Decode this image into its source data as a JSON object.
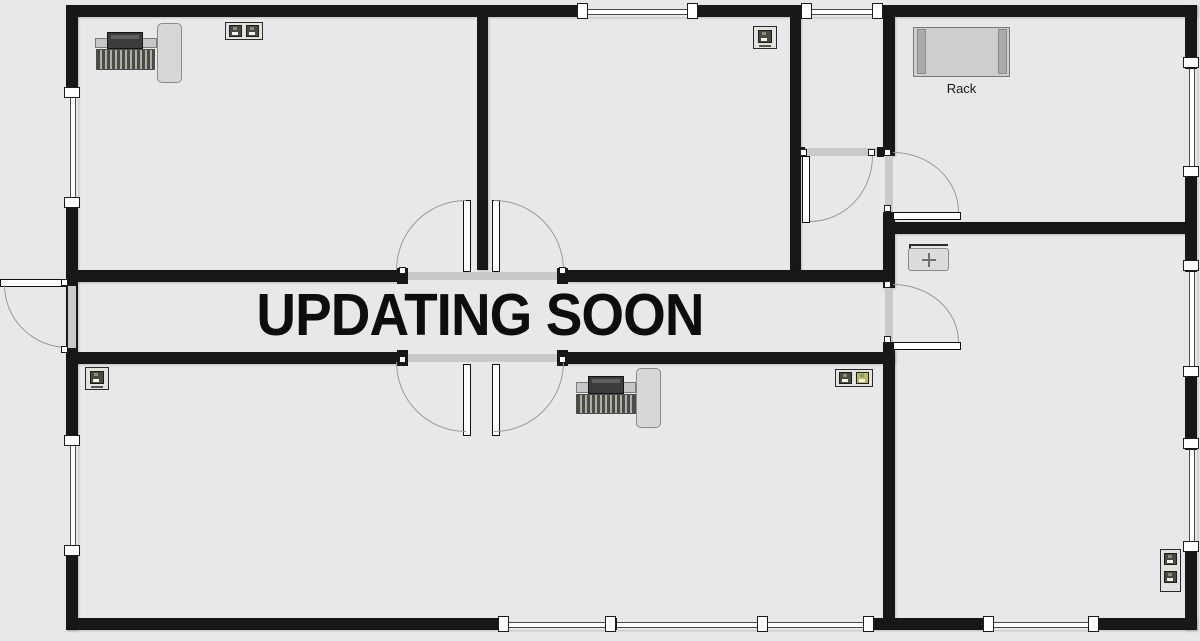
{
  "overlay": {
    "text": "UPDATING SOON"
  },
  "labels": {
    "rack": "Rack"
  },
  "colors": {
    "background": "#e8e8ea",
    "wall": "#171717",
    "door_opening": "#c9c9c9",
    "door_arc": "#999999",
    "furniture_fill": "#d7d7d7",
    "jack_dark": "#4a4a40",
    "jack_accent": "#b9b95e",
    "rack_fill": "#cecece"
  },
  "icons": {
    "workstation": "desk with monitor and keyboard, top view",
    "network_jack_double": "wall box with two RJ45 sockets",
    "network_jack_single": "wall box with one RJ45 socket",
    "network_jack_double_vertical": "vertical wall box with two RJ45 sockets",
    "rack": "equipment rack, top view",
    "switch": "small box with cross arrows"
  },
  "equipment": [
    {
      "type": "workstation",
      "room": "top-left-office"
    },
    {
      "type": "network-jack-double",
      "room": "top-left-office"
    },
    {
      "type": "network-jack-single",
      "room": "top-middle-office"
    },
    {
      "type": "rack",
      "room": "top-right-room",
      "label": "Rack"
    },
    {
      "type": "switch",
      "room": "right-room"
    },
    {
      "type": "network-jack-single",
      "room": "bottom-left-office"
    },
    {
      "type": "workstation",
      "room": "bottom-middle-office"
    },
    {
      "type": "network-jack-double",
      "room": "bottom-middle-office"
    },
    {
      "type": "network-jack-double-vertical",
      "room": "right-room"
    }
  ]
}
